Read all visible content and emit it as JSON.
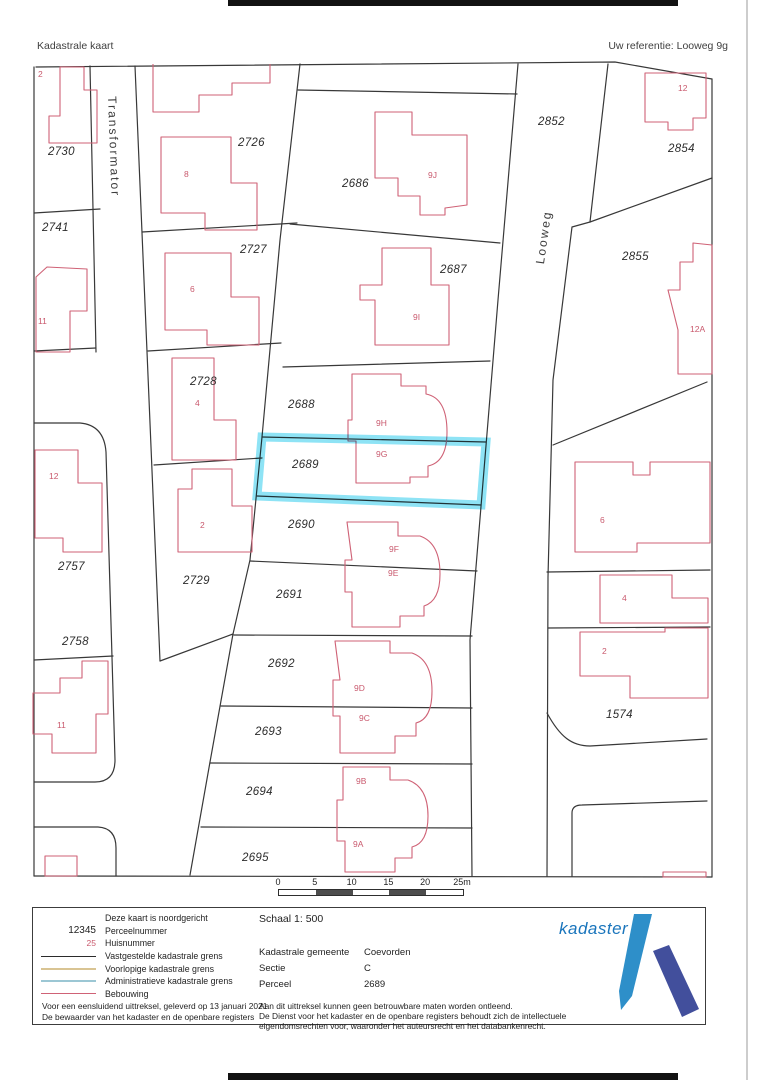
{
  "header": {
    "title": "Kadastrale kaart",
    "reference": "Uw referentie: Looweg 9g"
  },
  "map": {
    "parcel_labels": [
      {
        "t": "2730",
        "x": 48,
        "y": 146
      },
      {
        "t": "2741",
        "x": 42,
        "y": 222
      },
      {
        "t": "2757",
        "x": 58,
        "y": 561
      },
      {
        "t": "2758",
        "x": 62,
        "y": 636
      },
      {
        "t": "2726",
        "x": 238,
        "y": 137
      },
      {
        "t": "2727",
        "x": 240,
        "y": 244
      },
      {
        "t": "2728",
        "x": 190,
        "y": 376
      },
      {
        "t": "2729",
        "x": 183,
        "y": 575
      },
      {
        "t": "2686",
        "x": 342,
        "y": 178
      },
      {
        "t": "2687",
        "x": 440,
        "y": 264
      },
      {
        "t": "2688",
        "x": 288,
        "y": 399
      },
      {
        "t": "2689",
        "x": 292,
        "y": 459
      },
      {
        "t": "2690",
        "x": 288,
        "y": 519
      },
      {
        "t": "2691",
        "x": 276,
        "y": 589
      },
      {
        "t": "2692",
        "x": 268,
        "y": 658
      },
      {
        "t": "2693",
        "x": 255,
        "y": 726
      },
      {
        "t": "2694",
        "x": 246,
        "y": 786
      },
      {
        "t": "2695",
        "x": 242,
        "y": 852
      },
      {
        "t": "2852",
        "x": 538,
        "y": 116
      },
      {
        "t": "2854",
        "x": 668,
        "y": 143
      },
      {
        "t": "2855",
        "x": 622,
        "y": 251
      },
      {
        "t": "1574",
        "x": 606,
        "y": 709
      }
    ],
    "house_numbers": [
      {
        "t": "2",
        "x": 38,
        "y": 69
      },
      {
        "t": "11",
        "x": 38,
        "y": 316
      },
      {
        "t": "12",
        "x": 49,
        "y": 471
      },
      {
        "t": "11",
        "x": 57,
        "y": 720
      },
      {
        "t": "8",
        "x": 184,
        "y": 169
      },
      {
        "t": "6",
        "x": 190,
        "y": 284
      },
      {
        "t": "4",
        "x": 195,
        "y": 398
      },
      {
        "t": "2",
        "x": 200,
        "y": 520
      },
      {
        "t": "9J",
        "x": 428,
        "y": 170
      },
      {
        "t": "9I",
        "x": 413,
        "y": 312
      },
      {
        "t": "9H",
        "x": 376,
        "y": 418
      },
      {
        "t": "9G",
        "x": 376,
        "y": 449
      },
      {
        "t": "9F",
        "x": 389,
        "y": 544
      },
      {
        "t": "9E",
        "x": 388,
        "y": 568
      },
      {
        "t": "9D",
        "x": 354,
        "y": 683
      },
      {
        "t": "9C",
        "x": 359,
        "y": 713
      },
      {
        "t": "9B",
        "x": 356,
        "y": 776
      },
      {
        "t": "9A",
        "x": 353,
        "y": 839
      },
      {
        "t": "12",
        "x": 678,
        "y": 83
      },
      {
        "t": "12A",
        "x": 690,
        "y": 324
      },
      {
        "t": "6",
        "x": 600,
        "y": 515
      },
      {
        "t": "4",
        "x": 622,
        "y": 593
      },
      {
        "t": "2",
        "x": 602,
        "y": 646
      }
    ],
    "street_labels": [
      {
        "t": "Transformator",
        "x": 119,
        "y": 96,
        "r": 88
      },
      {
        "t": "Looweg",
        "x": 533,
        "y": 263,
        "r": -82
      }
    ],
    "highlighted_parcel": "2689",
    "scale_bar": {
      "tick_labels": [
        "0",
        "5",
        "10",
        "15",
        "20",
        "25m"
      ]
    }
  },
  "legend": {
    "north_note": "Deze kaart is noordgericht",
    "perceel_sample": "12345",
    "perceel_label": "Perceelnummer",
    "huis_sample": "25",
    "huis_label": "Huisnummer",
    "line_items": [
      {
        "label": "Vastgestelde kadastrale grens"
      },
      {
        "label": "Voorlopige kadastrale grens"
      },
      {
        "label": "Administratieve kadastrale grens"
      },
      {
        "label": "Bebouwing"
      }
    ],
    "footnotes": [
      "Voor een eensluidend uittreksel, geleverd op 13 januari 2021",
      "De bewaarder van het kadaster en de openbare registers"
    ]
  },
  "info": {
    "scale_text": "Schaal 1: 500",
    "fields": [
      {
        "label": "Kadastrale gemeente",
        "value": "Coevorden"
      },
      {
        "label": "Sectie",
        "value": "C"
      },
      {
        "label": "Perceel",
        "value": "2689"
      }
    ],
    "disclaimer": [
      "Aan dit uittreksel kunnen geen betrouwbare maten worden ontleend.",
      "De Dienst voor het kadaster en de openbare registers behoudt zich de intellectuele",
      "eigendomsrechten voor, waaronder het auteursrecht en het databankenrecht."
    ]
  },
  "logo": {
    "text": "kadaster"
  },
  "colors": {
    "highlight": "#1ec8ec",
    "building": "#cf6276",
    "boundary": "#383838",
    "provisional_border": "#d9c493",
    "administrative_border": "#9cc7d4",
    "logo_text": "#1a75bc",
    "logo_light": "#2e8fc9",
    "logo_dark": "#424f9c"
  }
}
